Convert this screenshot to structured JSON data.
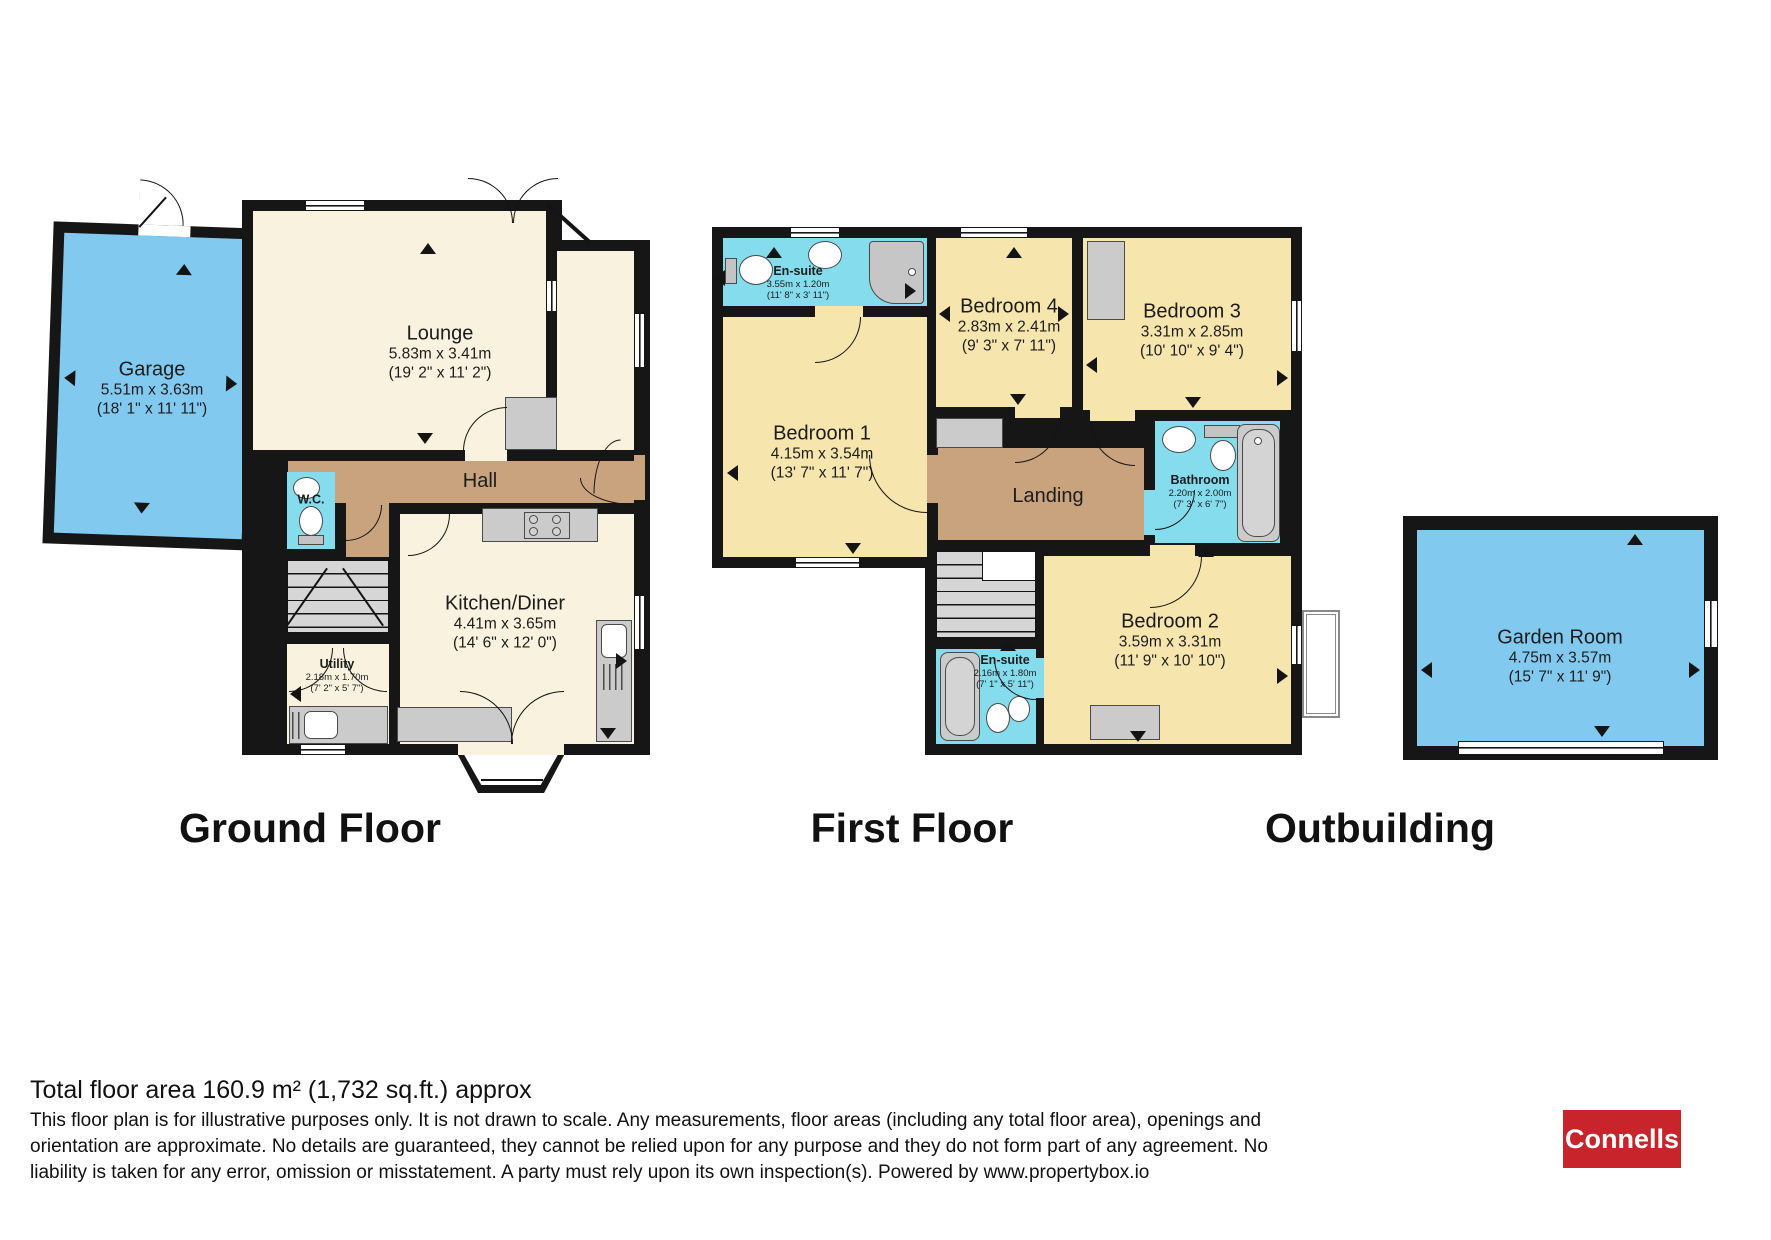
{
  "titles": {
    "ground": "Ground Floor",
    "first": "First Floor",
    "outbuilding": "Outbuilding"
  },
  "rooms": {
    "garage": {
      "name": "Garage",
      "metric": "5.51m x 3.63m",
      "imperial": "(18' 1\" x 11' 11\")"
    },
    "lounge": {
      "name": "Lounge",
      "metric": "5.83m x 3.41m",
      "imperial": "(19' 2\" x 11' 2\")"
    },
    "hall": {
      "name": "Hall"
    },
    "wc": {
      "name": "W.C."
    },
    "kitchen": {
      "name": "Kitchen/Diner",
      "metric": "4.41m x 3.65m",
      "imperial": "(14' 6\" x 12' 0\")"
    },
    "utility": {
      "name": "Utility",
      "metric": "2.18m x 1.70m",
      "imperial": "(7' 2\" x 5' 7\")"
    },
    "ensuite1": {
      "name": "En-suite",
      "metric": "3.55m x 1.20m",
      "imperial": "(11' 8\" x 3' 11\")"
    },
    "bedroom1": {
      "name": "Bedroom 1",
      "metric": "4.15m x 3.54m",
      "imperial": "(13' 7\" x 11' 7\")"
    },
    "bedroom4": {
      "name": "Bedroom 4",
      "metric": "2.83m x 2.41m",
      "imperial": "(9' 3\" x 7' 11\")"
    },
    "bedroom3": {
      "name": "Bedroom 3",
      "metric": "3.31m x 2.85m",
      "imperial": "(10' 10\" x 9' 4\")"
    },
    "bathroom": {
      "name": "Bathroom",
      "metric": "2.20m x 2.00m",
      "imperial": "(7' 3\" x 6' 7\")"
    },
    "landing": {
      "name": "Landing"
    },
    "ensuite2": {
      "name": "En-suite",
      "metric": "2.16m x 1.80m",
      "imperial": "(7' 1\" x 5' 11\")"
    },
    "bedroom2": {
      "name": "Bedroom 2",
      "metric": "3.59m x 3.31m",
      "imperial": "(11' 9\" x 10' 10\")"
    },
    "gardenroom": {
      "name": "Garden Room",
      "metric": "4.75m x 3.57m",
      "imperial": "(15' 7\" x 11' 9\")"
    }
  },
  "footer": {
    "total_area": "Total floor area 160.9 m² (1,732 sq.ft.) approx",
    "disclaimer_line1": "This floor plan is for illustrative purposes only. It is not drawn to scale. Any measurements, floor areas (including any total floor area), openings and",
    "disclaimer_line2": "orientation are approximate. No details are guaranteed, they cannot be relied upon for any purpose and they do not form part of any agreement. No",
    "disclaimer_line3": "liability is taken for any error, omission or misstatement. A party must rely upon its own inspection(s). Powered by www.propertybox.io",
    "brand": "Connells"
  },
  "colors": {
    "wall": "#161616",
    "living_cream": "#F8F2DE",
    "bedroom_yellow": "#F6E6AE",
    "hall_tan": "#C8A37D",
    "wet_room_cyan": "#85DCEC",
    "garage_blue": "#82C9F0",
    "fixture_gray": "#CBCBCB",
    "brand_red": "#C8242C"
  }
}
